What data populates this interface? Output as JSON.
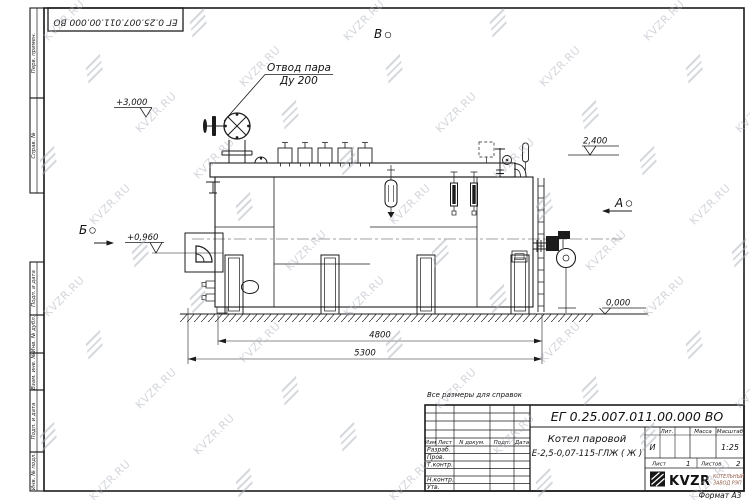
{
  "watermark": {
    "text": "KVZR.RU"
  },
  "stamp_top": {
    "designation": "ЕГ 0.25.007.011.00.000  ВО"
  },
  "side_labels": [
    "Перв. примен.",
    "Справ. №",
    "Подп. и дата",
    "Инв. № дубл.",
    "Взам. инв. №",
    "Подп. и дата",
    "Инв. № подл."
  ],
  "note": "Все размеры для справок",
  "drawing": {
    "callout_line1": "Отвод пара",
    "callout_line2": "Ду 200",
    "view_b": "Б",
    "view_a": "А",
    "view_v": "В",
    "elev_top": "+3,000",
    "elev_burner": "+0,960",
    "elev_right": "2,400",
    "elev_ground": "0,000",
    "dim_inner": "4800",
    "dim_overall": "5300"
  },
  "title_block": {
    "designation": "ЕГ 0.25.007.011.00.000  ВО",
    "product_name_line1": "Котел паровой",
    "product_name_line2": "Е-2,5-0,07-115-ГЛЖ ( Ж )",
    "headers": {
      "izm": "Изм",
      "list": "Лист",
      "n_dokum": "N докум.",
      "podp": "Подп.",
      "data": "Дата"
    },
    "roles": [
      "Разраб.",
      "Пров.",
      "Т.контр.",
      "Н.контр.",
      "Утв."
    ],
    "lit_label": "Лит.",
    "massa_label": "Масса",
    "masshtab_label": "Масштаб",
    "lit_value": "И",
    "scale_value": "1:25",
    "sheet_label": "Лист",
    "sheet_value": "1",
    "sheets_label": "Листов",
    "sheets_value": "2",
    "company": "KVZR",
    "company_sub1": "КОТЕЛЬНЫЙ",
    "company_sub2": "ЗАВОД РЭП",
    "format_label": "Формат А3"
  }
}
